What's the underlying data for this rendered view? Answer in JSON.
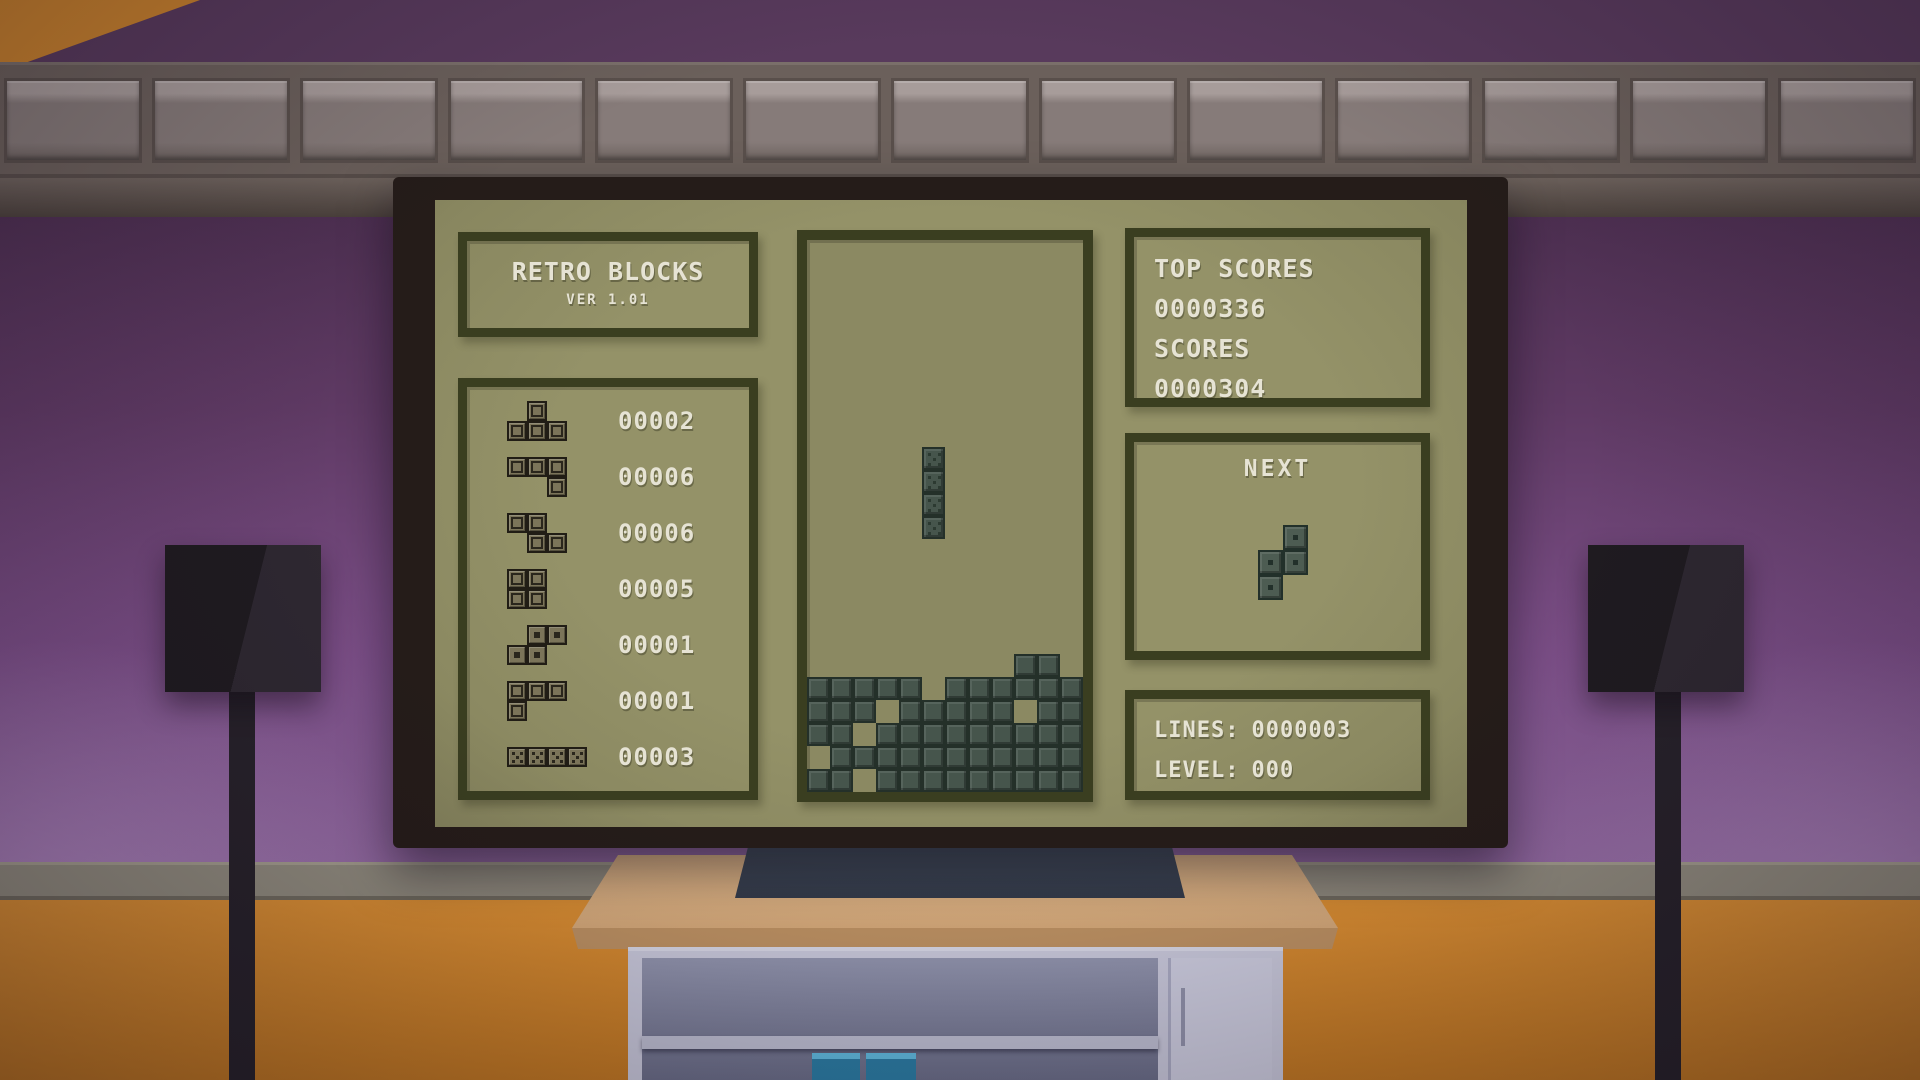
{
  "screen": {
    "title": "RETRO BLOCKS",
    "version": "VER 1.01",
    "stats": [
      {
        "piece": "T",
        "count": "00002"
      },
      {
        "piece": "J",
        "count": "00006"
      },
      {
        "piece": "Z",
        "count": "00006"
      },
      {
        "piece": "O",
        "count": "00005"
      },
      {
        "piece": "S",
        "count": "00001"
      },
      {
        "piece": "L",
        "count": "00001"
      },
      {
        "piece": "I",
        "count": "00003"
      }
    ],
    "scores_panel": {
      "lines": [
        "TOP SCORES",
        "0000336",
        "SCORES",
        "0000304"
      ]
    },
    "next_panel": {
      "label": "NEXT",
      "piece": "S_vertical"
    },
    "info_panel": {
      "lines_label": "LINES:",
      "lines_value": "0000003",
      "level_label": "LEVEL:",
      "level_value": "000"
    },
    "board": {
      "cols": 12,
      "rows": 24,
      "falling_piece": {
        "type": "I",
        "orientation": "vertical",
        "col": 5,
        "top_row": 9,
        "length": 4
      },
      "stack_rows": [
        "---------XX-",
        "XXXXX-XXXXXX",
        "XXX-XXXXX-XX",
        "XX-XXXXXXXXX",
        "-XXXXXXXXXXX",
        "XX-XXXXXXXXX"
      ]
    }
  },
  "pieces": {
    "shapes": {
      "T": [
        "010",
        "111"
      ],
      "J": [
        "111",
        "001"
      ],
      "Z": [
        "110",
        "011"
      ],
      "O": [
        "11",
        "11"
      ],
      "S": [
        "011",
        "110"
      ],
      "L": [
        "111",
        "100"
      ],
      "I": [
        "1111"
      ],
      "S_vertical": [
        "01",
        "11",
        "10"
      ]
    },
    "glyphs": {
      "T": "ring",
      "J": "ring",
      "Z": "ring",
      "O": "ring",
      "S": "dot",
      "L": "ring",
      "I": "dice"
    }
  },
  "colors": {
    "screen_bg": "#8f8d66",
    "panel_border": "#3a3e20",
    "text": "#e6e3d4",
    "field_block": "#46554c",
    "stat_block": "#7b7459",
    "wall": "#7c4f88",
    "floor": "#d88d33",
    "tv_frame": "#251c19",
    "table_top": "#ddb588",
    "cabinet_body": "#c6c6d8"
  }
}
